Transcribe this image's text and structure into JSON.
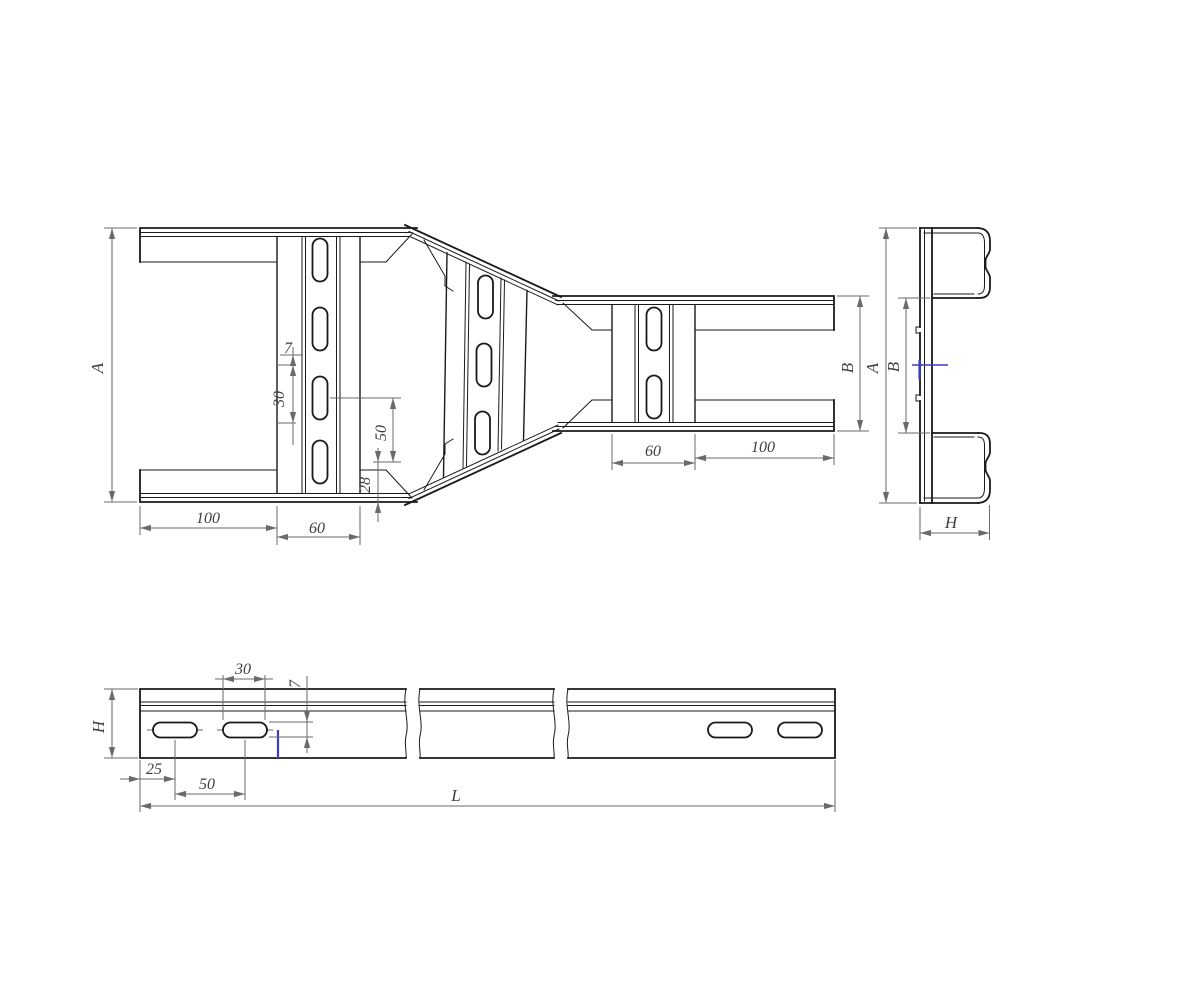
{
  "plan_view": {
    "dim_a": "A",
    "dim_7": "7",
    "dim_30": "30",
    "dim_50": "50",
    "dim_28": "28",
    "dim_100_left": "100",
    "dim_60_left": "60",
    "dim_60_right": "60",
    "dim_100_right": "100",
    "dim_b": "B"
  },
  "end_view": {
    "dim_a": "A",
    "dim_b": "B",
    "dim_h": "H"
  },
  "side_view": {
    "dim_h": "H",
    "dim_30": "30",
    "dim_7": "7",
    "dim_25": "25",
    "dim_50": "50",
    "dim_l": "L"
  },
  "colors": {
    "line": "#1a1a1a",
    "dim": "#6a6a6a",
    "text": "#3f3f3f",
    "accent": "#3c3cc8",
    "background": "#ffffff"
  }
}
